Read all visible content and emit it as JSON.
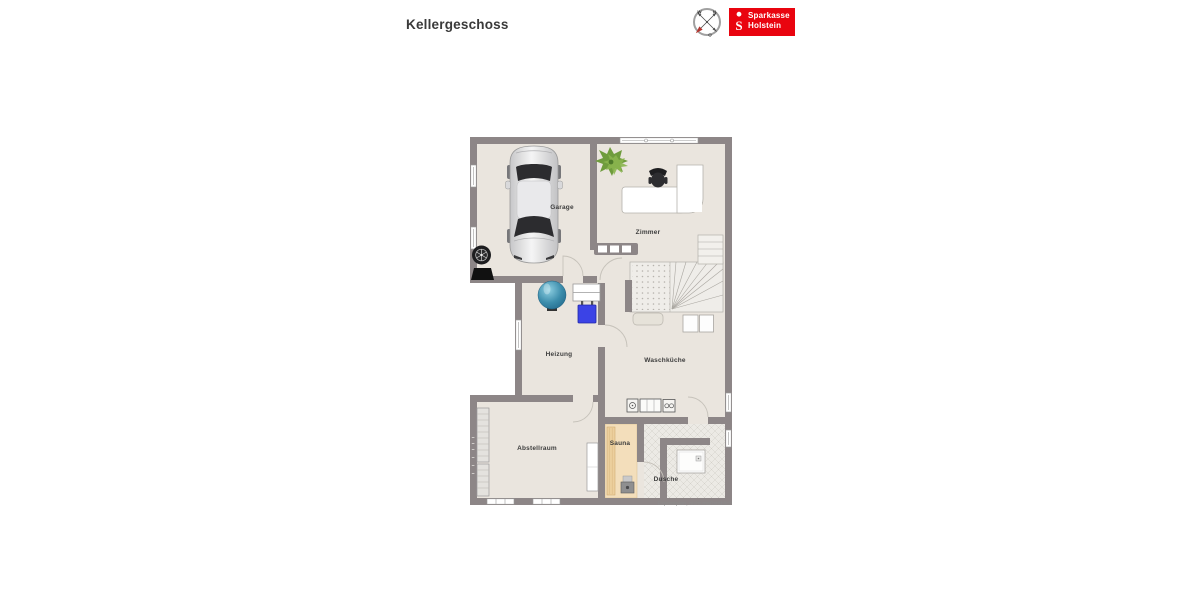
{
  "page": {
    "title": "Kellergeschoss",
    "caption": "Exposéplan, nicht maßstäblich"
  },
  "branding": {
    "name_line1": "Sparkasse",
    "name_line2": "Holstein",
    "logo_color": "#e9040f"
  },
  "compass": {
    "west": "W",
    "north": "N",
    "east": "O"
  },
  "floorplan": {
    "rooms": [
      {
        "name": "Garage"
      },
      {
        "name": "Zimmer"
      },
      {
        "name": "Heizung"
      },
      {
        "name": "Waschküche"
      },
      {
        "name": "Abstellraum"
      },
      {
        "name": "Sauna"
      },
      {
        "name": "Dusche"
      }
    ],
    "colors": {
      "wall": "#8d8687",
      "floor": "#eae5de",
      "sauna_wood": "#f3debb",
      "tile_floor": "#eceae5",
      "tank_blue": "#2f84a8",
      "boiler_blue": "#3b43e6",
      "brand_red": "#e9040f"
    },
    "icons": {
      "compass": "compass-rose",
      "logo_mark": "sparkasse-s",
      "garage_items": [
        "car-top-view",
        "tire-stack"
      ],
      "zimmer_items": [
        "potted-plant",
        "corner-desk",
        "office-chair"
      ],
      "heizung_items": [
        "heating-tank",
        "boiler",
        "wall-shelf"
      ],
      "waschkueche_items": [
        "winder-staircase",
        "washing-machines",
        "meter-cabinet"
      ],
      "bad_items": [
        "sauna-bench",
        "sauna-heater",
        "shower-tray"
      ]
    }
  }
}
